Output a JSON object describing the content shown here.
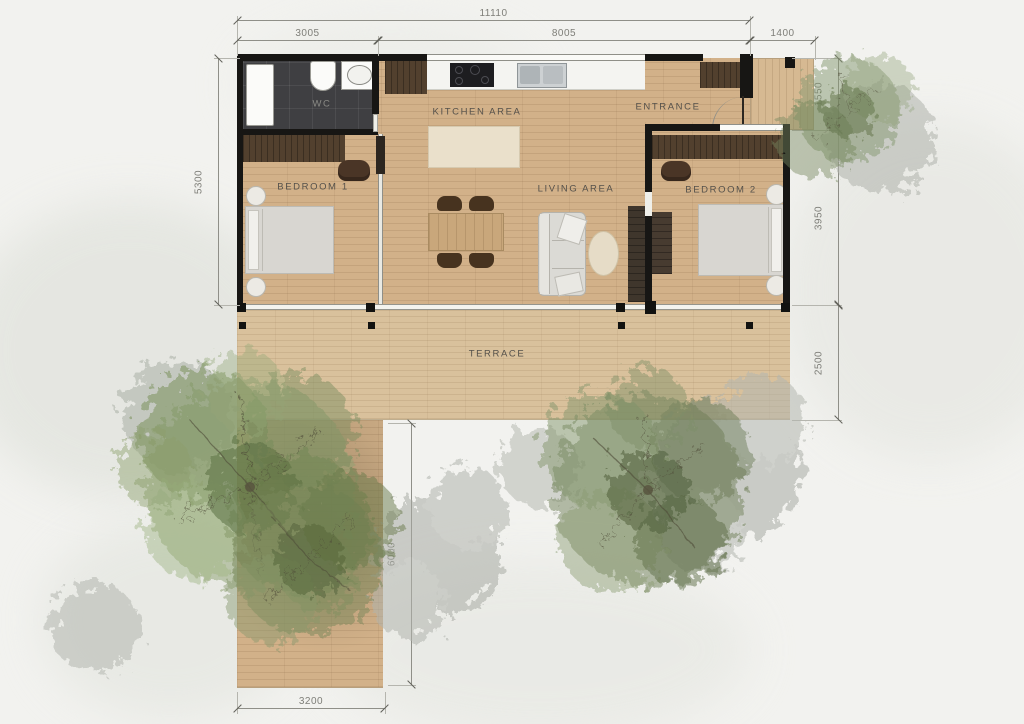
{
  "plan": {
    "rooms": {
      "wc": "WC",
      "kitchen": "KITCHEN AREA",
      "entrance": "ENTRANCE",
      "bedroom1": "BEDROOM 1",
      "living": "LIVING AREA",
      "bedroom2": "BEDROOM 2",
      "terrace": "TERRACE"
    },
    "dimensions": {
      "total_width": "11110",
      "wc_section_width": "3005",
      "main_section_width": "8005",
      "porch_width": "1400",
      "left_height": "5300",
      "porch_depth": "1550",
      "bedroom2_depth": "3950",
      "terrace_depth": "2500",
      "path_length": "6000",
      "path_width": "3200"
    },
    "colors": {
      "floor_wood": "#d2b189",
      "terrace_wood": "#d9c19c",
      "wall": "#171614",
      "dark_wood": "#52402e",
      "wc_tile": "#3f3f42",
      "room_label_text": "#55514b",
      "dim_text": "#7e7e78",
      "tree_green": "#7e9161",
      "tree_shadow_gray": "#a9aca5",
      "background": "#f2f2ef"
    }
  }
}
